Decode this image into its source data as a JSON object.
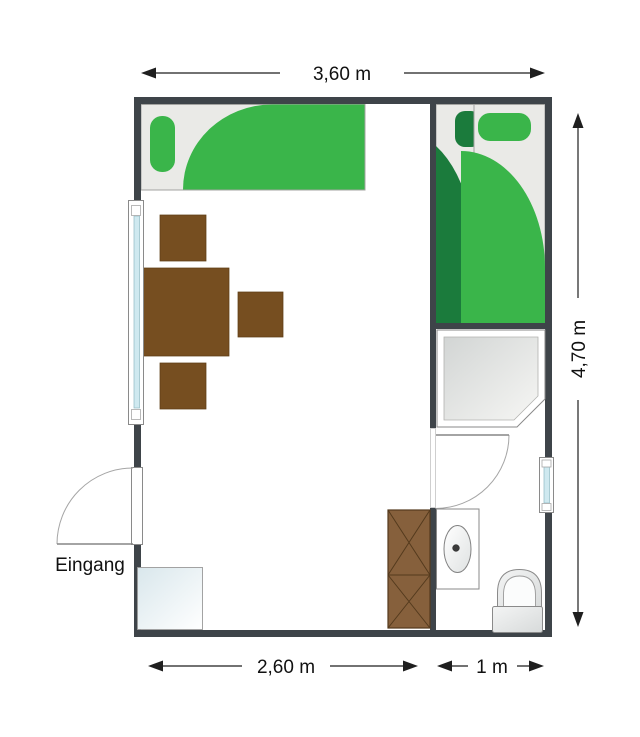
{
  "plan": {
    "dimensions": {
      "top": "3,60 m",
      "right": "4,70 m",
      "bottom_main": "2,60 m",
      "bottom_bath": "1 m"
    },
    "labels": {
      "entrance": "Eingang"
    }
  },
  "colors": {
    "wall": "#3e4449",
    "green": "#3ab54a",
    "darkgreen": "#1b7b3c",
    "bedbase": "#eaeae7",
    "bedborder": "#a3a3a0",
    "brown": "#764e20",
    "brownedge": "#5f3d15",
    "wardrobe": "#86603c",
    "wardrobeline": "#543a1d",
    "glass": "#cfe9f0",
    "fixture": "#8a8a8a",
    "dimline": "#1f1f1f",
    "text": "#111111"
  }
}
